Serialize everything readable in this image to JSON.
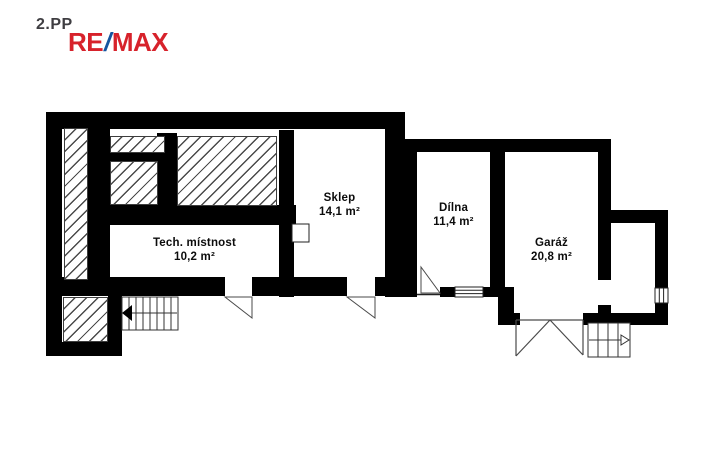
{
  "header": {
    "floor_label": "2.PP",
    "brand": {
      "part1": "RE",
      "slash": "/",
      "part2": "MAX",
      "red": "#d7222b",
      "blue": "#15559f",
      "floor_label_color": "#3e3d41"
    }
  },
  "rooms": [
    {
      "id": "tech",
      "name": "Tech. místnost",
      "area": "10,2 m²"
    },
    {
      "id": "sklep",
      "name": "Sklep",
      "area": "14,1 m²"
    },
    {
      "id": "dilna",
      "name": "Dílna",
      "area": "11,4 m²"
    },
    {
      "id": "garaz",
      "name": "Garáž",
      "area": "20,8 m²"
    }
  ],
  "colors": {
    "wall": "#000000",
    "background": "#ffffff",
    "hatch_line": "#4a4a4a",
    "symbol_stroke": "#4a4a4a"
  }
}
